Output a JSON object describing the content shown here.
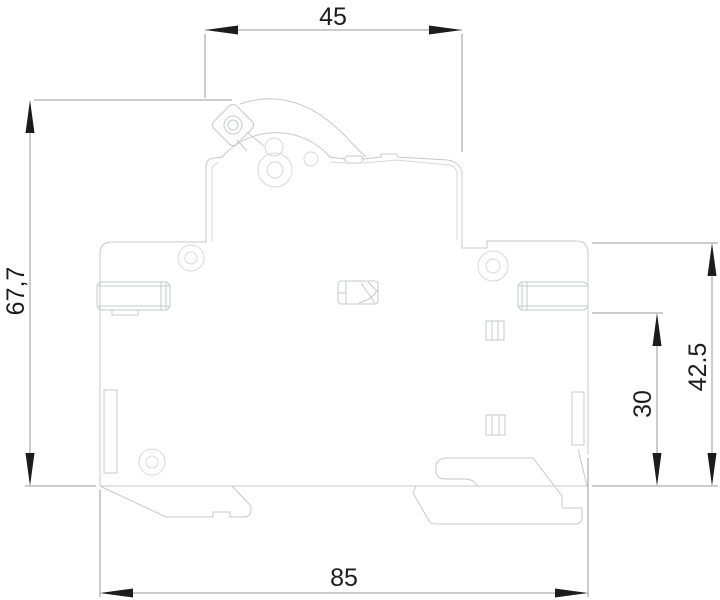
{
  "drawing": {
    "kind": "technical-dimension-drawing",
    "view": "side-profile-outline"
  },
  "dimensions": {
    "top_width": "45",
    "left_height": "67,7",
    "right_height": "42.5",
    "right_inner_height": "30",
    "bottom_width": "85"
  },
  "colors": {
    "background": "#ffffff",
    "outline": "#c7c9c9",
    "outline_light": "#d6d8d8",
    "dimension_line": "#9a9a9a",
    "dimension_text": "#1c1c1c",
    "arrow_fill": "#1c1c1c"
  }
}
